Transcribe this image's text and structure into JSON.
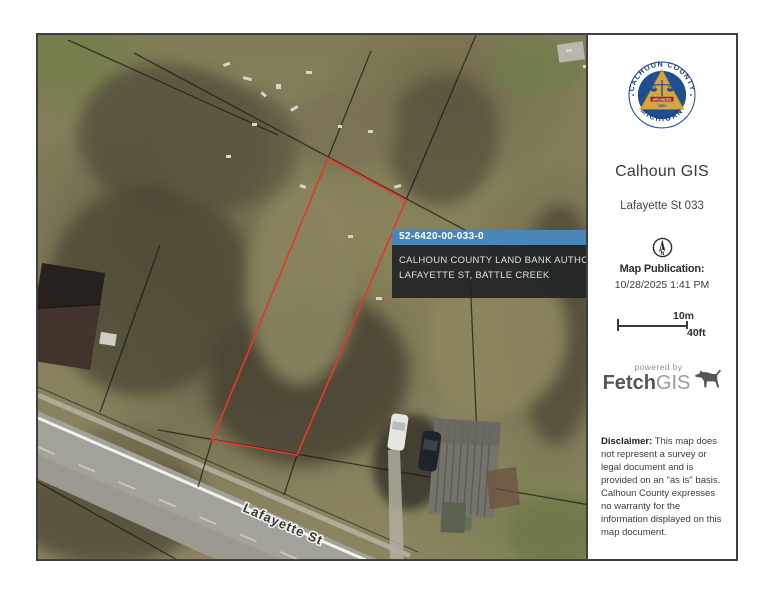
{
  "map": {
    "street_label": "Lafayette St",
    "callout": {
      "parcel_id": "52-6420-00-033-0",
      "owner": "CALHOUN COUNTY LAND BANK AUTHORIT",
      "address": "LAFAYETTE ST, BATTLE CREEK",
      "header_color": "#4a86b8"
    },
    "parcel_outline_color": "#e8392c"
  },
  "sidebar": {
    "seal": {
      "arc_top": "CALHOUN COUNTY",
      "arc_bottom": "MICHIGAN",
      "ribbon": "ORGANIZED",
      "year": "1833",
      "blue": "#204f8f",
      "gold": "#d8a63e"
    },
    "title": "Calhoun GIS",
    "subtitle": "Lafayette St 033",
    "north_letter": "N",
    "publication_label": "Map Publication:",
    "publication_datetime": "10/28/2025 1:41 PM",
    "scale": {
      "metric": "10m",
      "imperial": "40ft"
    },
    "powered_by": "powered by",
    "brand_fetch": "Fetch",
    "brand_gis": "GIS",
    "disclaimer_label": "Disclaimer:",
    "disclaimer_text": " This map does not represent a survey or legal document and is provided on an \"as is\" basis. Calhoun County expresses no warranty for the information displayed on this map document."
  }
}
